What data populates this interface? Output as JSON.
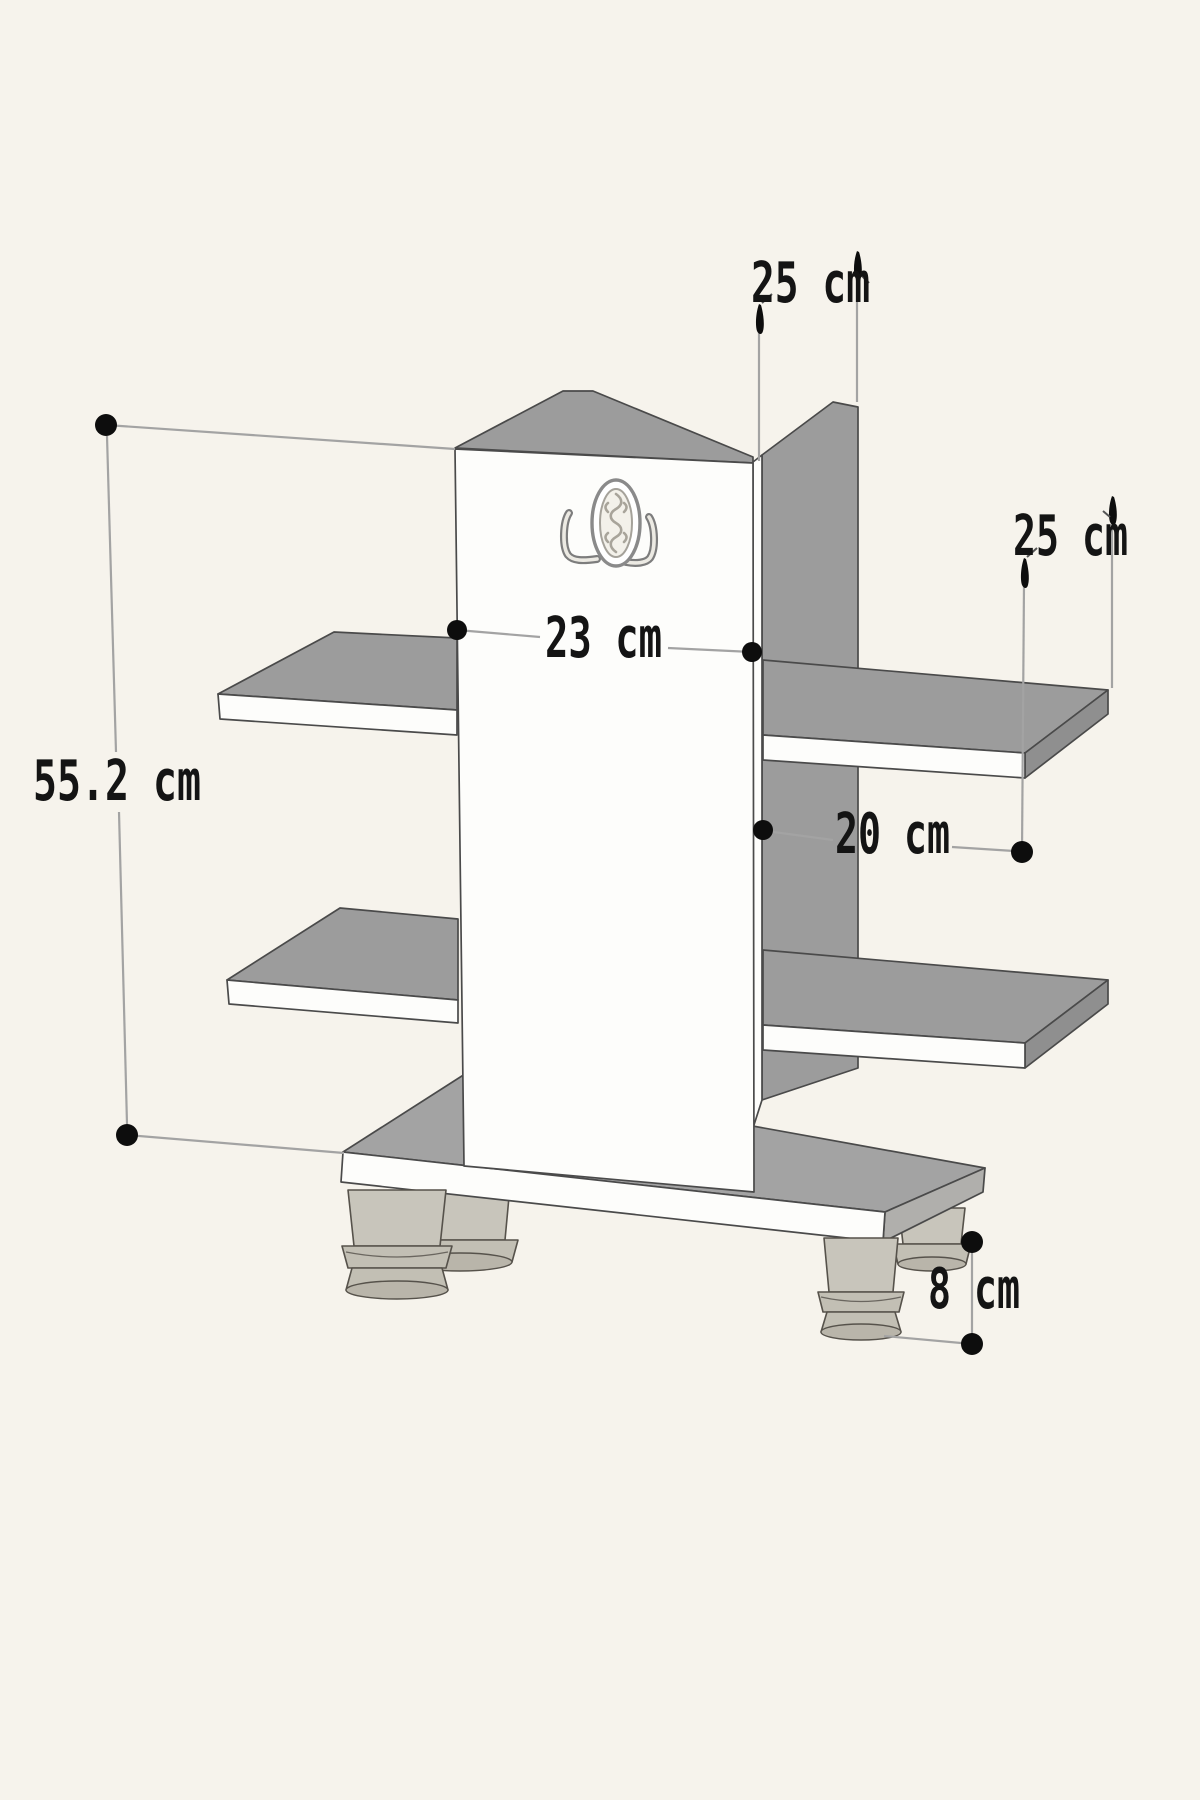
{
  "title": "Shelf unit dimension drawing",
  "dimensions": {
    "height": {
      "label": "55.2 cm"
    },
    "spine_width": {
      "label": "23 cm"
    },
    "top_depth": {
      "label": "25 cm"
    },
    "shelf_depth": {
      "label": "25 cm"
    },
    "shelf_gap": {
      "label": "20 cm"
    },
    "leg_height": {
      "label": "8 cm"
    }
  },
  "icons": {
    "emblem": "oval-ornament-emblem"
  },
  "colors": {
    "background": "#f6f3ec",
    "panel_white": "#fdfdfb",
    "panel_gray": "#9c9c9c",
    "panel_gray_dark": "#8f8f8f",
    "base_gray": "#a3a3a3",
    "leg_gray": "#c8c5bb",
    "dimension_line": "#a3a3a3",
    "dimension_text": "#141414",
    "dimension_dot": "#0d0d0d"
  }
}
